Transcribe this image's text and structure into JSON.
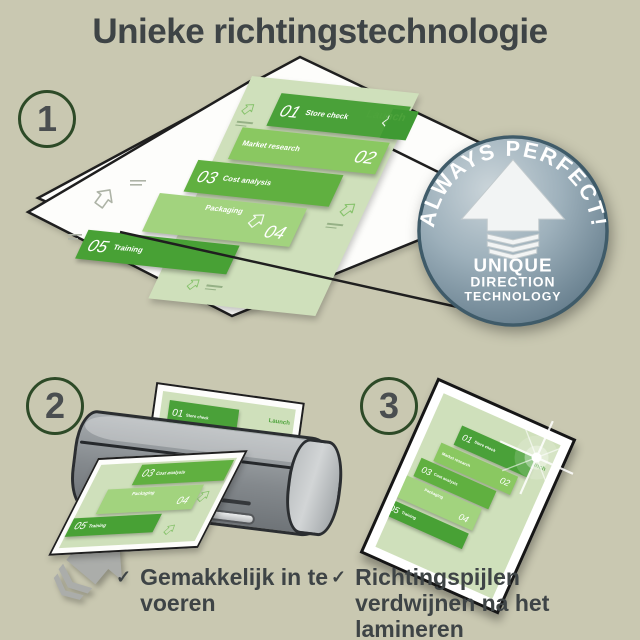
{
  "title": "Unieke richtingstechnologie",
  "steps": [
    {
      "number": "1"
    },
    {
      "number": "2"
    },
    {
      "number": "3"
    }
  ],
  "infographic": {
    "launch_label": "Launch",
    "items": [
      {
        "num": "01",
        "label": "Store check"
      },
      {
        "num": "02",
        "label": "Market research"
      },
      {
        "num": "03",
        "label": "Cost analysis"
      },
      {
        "num": "04",
        "label": "Packaging"
      },
      {
        "num": "05",
        "label": "Training"
      }
    ]
  },
  "badge": {
    "arc_text": "ALWAYS PERFECT!",
    "line1": "UNIQUE",
    "line2": "DIRECTION",
    "line3": "TECHNOLOGY"
  },
  "bullets": [
    {
      "check": "✓",
      "text": "Gemakkelijk in te voeren"
    },
    {
      "check": "✓",
      "text": "Richtingspijlen verdwijnen na het lamineren"
    }
  ],
  "colors": {
    "bg": "#c9c8b1",
    "ink": "#3e4446",
    "ring-green": "#2d4a27",
    "step-number": "#4a4e50",
    "page-green": "#cfe0bb",
    "band-green-1": "#4aa139",
    "band-green-2": "#8ac861",
    "band-green-3": "#60b040",
    "band-green-4": "#a2d37e",
    "band-green-5": "#48a135",
    "launch-green": "#4da33b",
    "laminator-gray": "#84898d",
    "arrow-gray": "#abadaa",
    "badge-blue": "#8ba0ad",
    "badge-rim": "#3f5b69",
    "sheet-white": "#fdfdfb",
    "outline-black": "#1f1f1f"
  }
}
